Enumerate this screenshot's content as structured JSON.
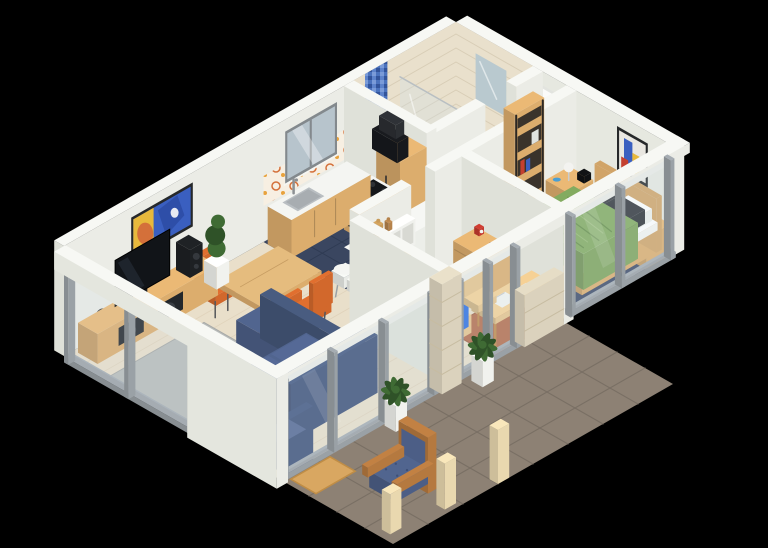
{
  "scene": {
    "description": "Isometric 3D rendering of a furnished apartment floor plan with living room, kitchen, bathroom, hallway, kids bedroom, master bedroom and a stone terrace",
    "background": "#000000",
    "rooms": [
      {
        "id": "living-room",
        "contents": [
          "tv-console",
          "tv",
          "speakers",
          "floor-plant",
          "dining-table",
          "orange-chairs",
          "blue-sectional-sofa",
          "blue-armchair",
          "gray-rug",
          "abstract-wall-art",
          "west-glass-window"
        ]
      },
      {
        "id": "kitchen",
        "contents": [
          "l-shaped-counter",
          "sink",
          "faucet",
          "cooktop",
          "oven",
          "range-hood",
          "tall-fridge-cabinet",
          "breakfast-bar",
          "bar-stools",
          "red-kitchen-scale",
          "bowls",
          "navy-tile-floor",
          "orange-patterned-backsplash",
          "window"
        ]
      },
      {
        "id": "bathroom",
        "contents": [
          "shower-tray",
          "shower-glass-panel",
          "blue-mosaic-accent-strip",
          "beige-wall-tiles",
          "mirror"
        ]
      },
      {
        "id": "hallway",
        "contents": [
          "entrance-door",
          "open-wood-shelf"
        ]
      },
      {
        "id": "kids-bedroom",
        "contents": [
          "blue-single-bed",
          "wall-shelf",
          "wood-figurines",
          "dresser",
          "teddy-bear",
          "red-alarm-clock",
          "desk",
          "white-laptop",
          "notebook",
          "wooden-chair",
          "basketball",
          "soccer-ball",
          "terracotta-rug"
        ]
      },
      {
        "id": "master-bedroom",
        "contents": [
          "wooden-double-bed",
          "green-duvet",
          "dark-pillows",
          "nightstands",
          "table-lamp",
          "digital-clock",
          "abstract-wall-art",
          "navy-rug",
          "low-bench",
          "laptop"
        ]
      },
      {
        "id": "terrace",
        "contents": [
          "stone-tile-floor",
          "doormat",
          "potted-ferns",
          "wooden-armchair-blue-cushions",
          "wooden-posts",
          "glass-sliding-walls",
          "stone-pillar",
          "stone-half-wall"
        ]
      }
    ],
    "palette": {
      "background": "#000000",
      "wallFace": "#ebece6",
      "wallSide": "#dfe1d9",
      "wallTop": "#f7f8f4",
      "floorWood": "#e9dfca",
      "plank": "#d8c8ae",
      "kitchenFloor": "#3a4660",
      "kitchenGrid": "#2f3b53",
      "bathFloor": "#e8e7e2",
      "bathGrid": "#dbdad4",
      "terrace": "#8d8174",
      "terraceGrid": "#796f64",
      "glassTint": "#cfdfe9",
      "frameGray": "#9aa1a6",
      "wood": "#dcad6d",
      "woodLight": "#e6c38b",
      "woodPale": "#e9d8af",
      "legBrown": "#c08a4a",
      "woodFrame": "#b5793f",
      "white": "#f2f3ef",
      "dark": "#17191d",
      "steel": "#8c9093",
      "sofaBlue": "#4c5e86",
      "sofaDark": "#3e5078",
      "sofaArm": "#445678",
      "orange": "#d2682c",
      "rugGray": "#b9bcba",
      "rugNavy": "#3e4a68",
      "rugTerra": "#b46c4c",
      "duvetGreen": "#7da35b",
      "duvetBlue": "#2e6fe2",
      "pillowBlue": "#8fb2ef",
      "pillowDark": "#33363b",
      "mattress": "#f4f4f1",
      "stone": "#dbd2bd",
      "stoneBand": "#c7bca1",
      "tileBeige": "#e9e0cc",
      "tileLine": "#d8cdb6",
      "mosaicA": "#4a72bd",
      "mosaicB": "#7a9bd8",
      "mosaicC": "#32549b",
      "mosaicD": "#5d83cb",
      "splashBg": "#f7efe2",
      "splashA": "#d4703a",
      "splashB": "#e8a23c",
      "doormat": "#d9a761",
      "doormatEdge": "#bf8d46",
      "plantGreen": "#3f6b34",
      "plantDark": "#2f5228",
      "pot": "#f1f2ee",
      "ballOrange": "#d9722e",
      "ballLine": "#a34f1d",
      "soccerWhite": "#f2f3f0",
      "red": "#c3392f",
      "teddy": "#8a5d3b",
      "lampWhite": "#f3f3f0",
      "clockBlue": "#4a9fd4",
      "mirror": "#b9c9cf",
      "artBlue": "#3a5fc0",
      "artYellow": "#e8b93c",
      "artOrange": "#d4703a",
      "artRed": "#c4402f",
      "artFrame": "#26282a",
      "door": "#fbfbf9",
      "doorFrame": "#e2e4df"
    }
  }
}
